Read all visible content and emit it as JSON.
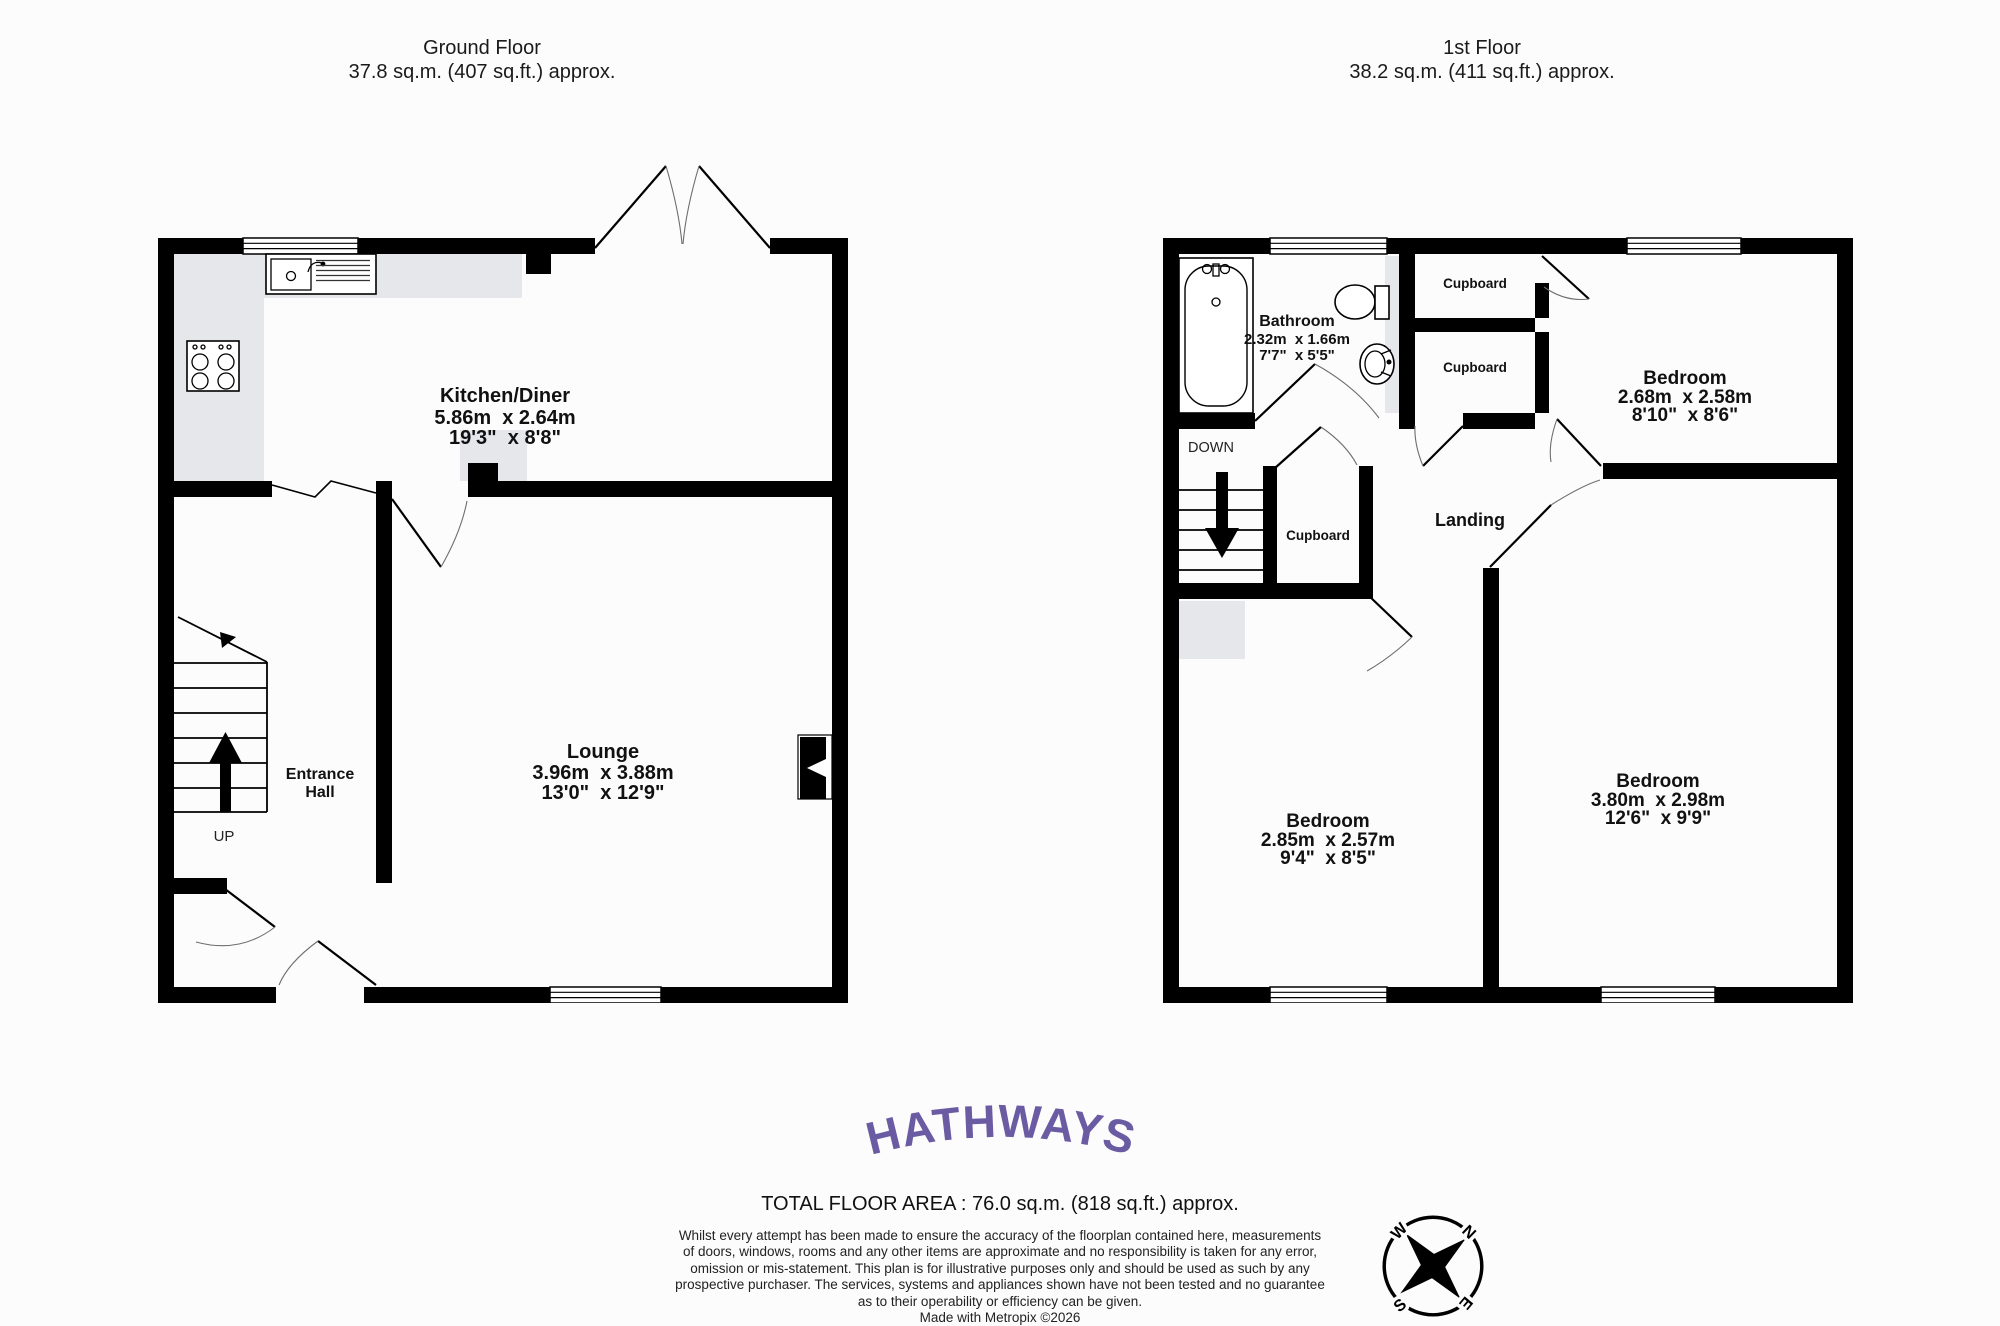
{
  "ground_floor": {
    "title": "Ground Floor",
    "area": "37.8 sq.m. (407 sq.ft.) approx.",
    "kitchen_diner": {
      "name": "Kitchen/Diner",
      "metric": "5.86m  x 2.64m",
      "imperial": "19'3\"  x 8'8\""
    },
    "lounge": {
      "name": "Lounge",
      "metric": "3.96m  x 3.88m",
      "imperial": "13'0\"  x 12'9\""
    },
    "entrance_hall": {
      "line1": "Entrance",
      "line2": "Hall"
    },
    "up": "UP"
  },
  "first_floor": {
    "title": "1st Floor",
    "area": "38.2 sq.m. (411 sq.ft.) approx.",
    "bathroom": {
      "name": "Bathroom",
      "metric": "2.32m  x 1.66m",
      "imperial": "7'7\"  x 5'5\""
    },
    "bedroom_top": {
      "name": "Bedroom",
      "metric": "2.68m  x 2.58m",
      "imperial": "8'10\"  x 8'6\""
    },
    "bedroom_left": {
      "name": "Bedroom",
      "metric": "2.85m  x 2.57m",
      "imperial": "9'4\"  x 8'5\""
    },
    "bedroom_right": {
      "name": "Bedroom",
      "metric": "3.80m  x 2.98m",
      "imperial": "12'6\"  x 9'9\""
    },
    "cupboard1": "Cupboard",
    "cupboard2": "Cupboard",
    "cupboard3": "Cupboard",
    "landing": "Landing",
    "down": "DOWN"
  },
  "compass": {
    "n": "N",
    "e": "E",
    "s": "S",
    "w": "W"
  },
  "footer": {
    "brand": "HATHWAYS",
    "total_area": "TOTAL FLOOR AREA : 76.0 sq.m. (818 sq.ft.) approx.",
    "disclaimer_lines": [
      "Whilst every attempt has been made to ensure the accuracy of the floorplan contained here, measurements",
      "of doors, windows, rooms and any other items are approximate and no responsibility is taken for any error,",
      "omission or mis-statement. This plan is for illustrative purposes only and should be used as such by any",
      "prospective purchaser. The services, systems and appliances shown have not been tested and no guarantee",
      "as to their operability or efficiency can be given."
    ],
    "credit": "Made with Metropix ©2026"
  },
  "colors": {
    "wall": "#000000",
    "kitchen_counter": "#e5e7ea",
    "logo_purple": "#6a5ba3",
    "background": "#fcfcfc"
  }
}
